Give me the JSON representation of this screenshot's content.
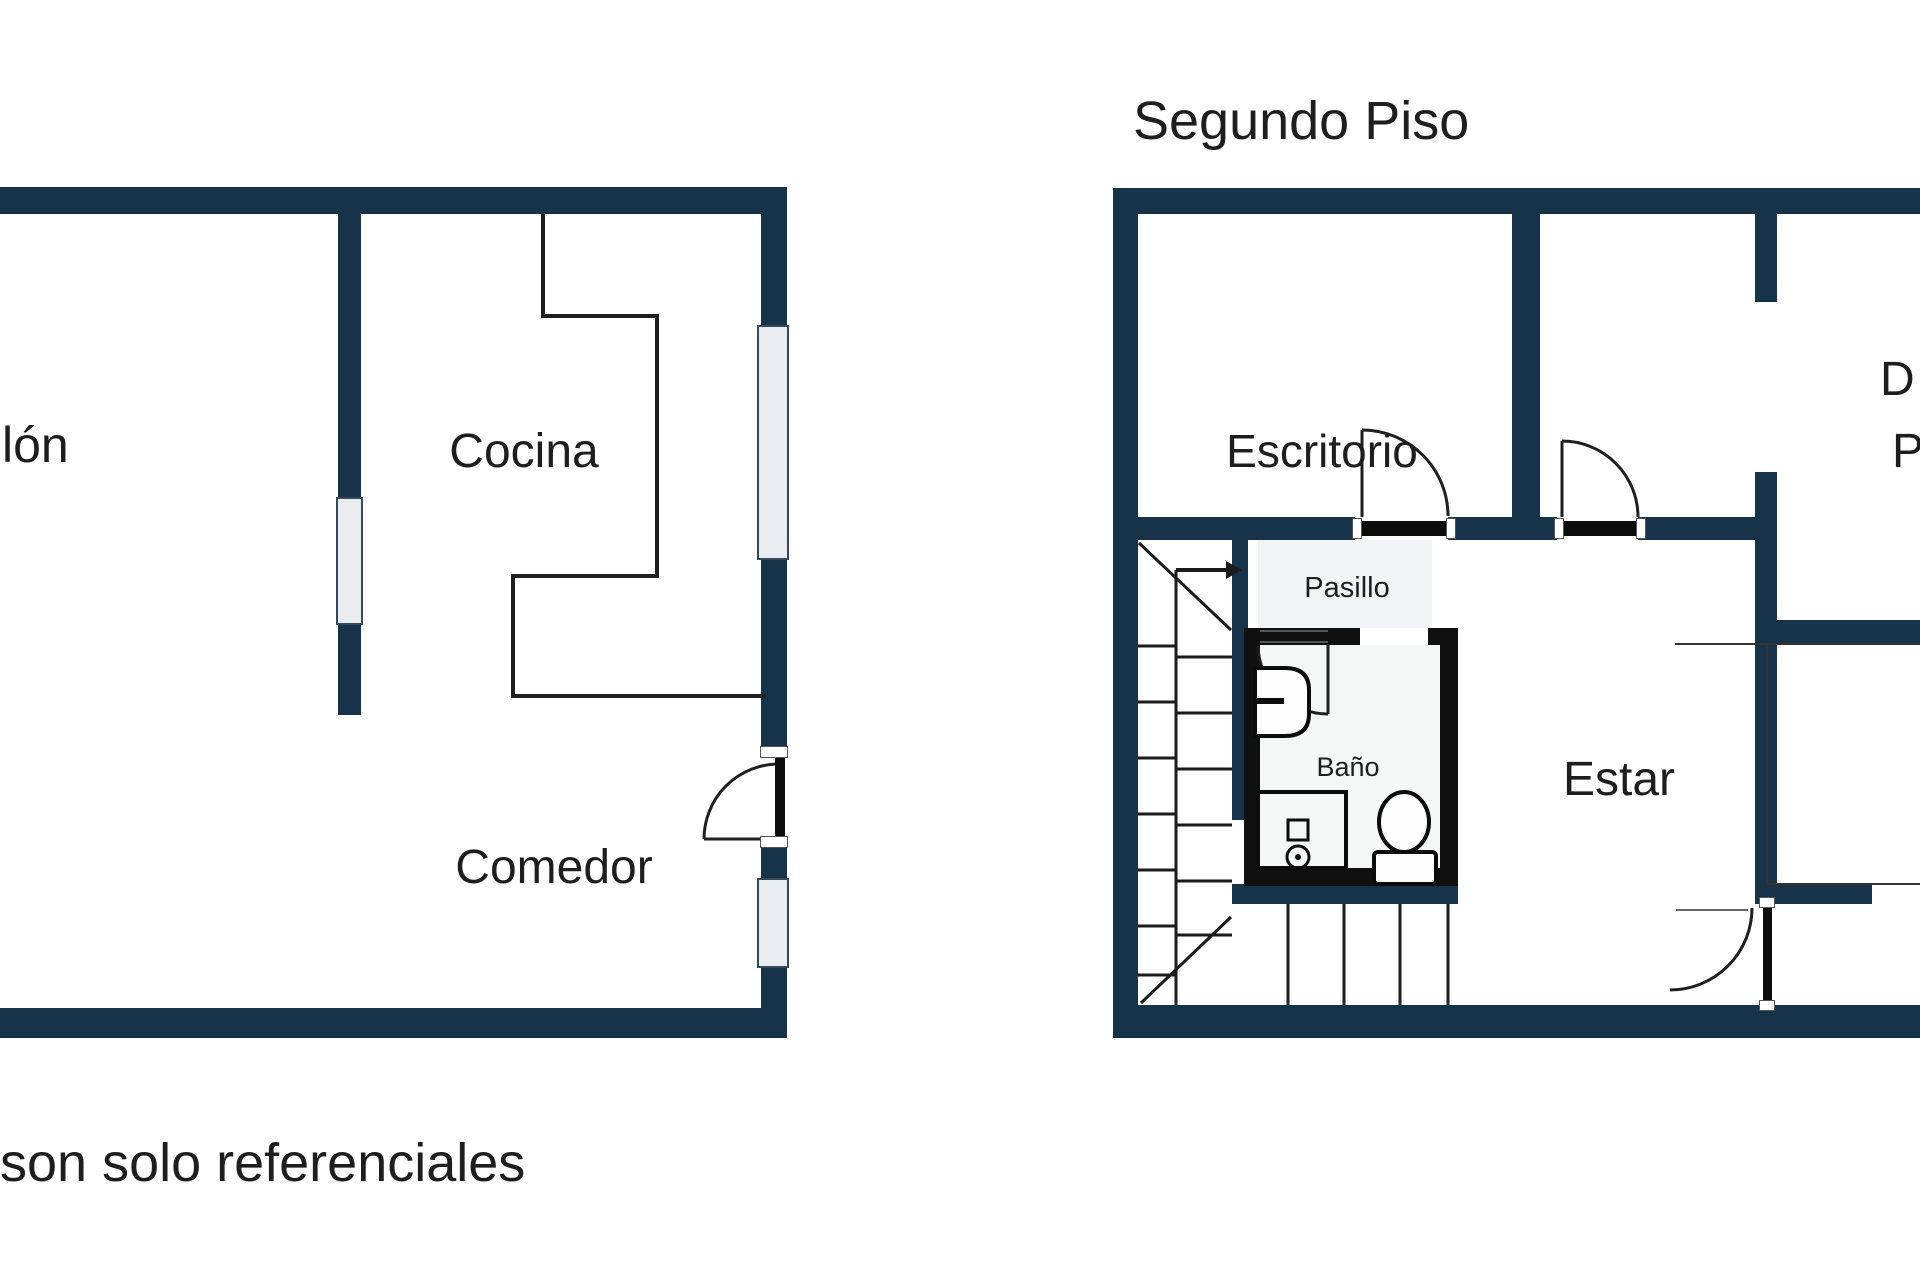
{
  "second_floor_title": "Segundo Piso",
  "footnote_fragment": "son solo referenciales",
  "floor1": {
    "salon_fragment": "lón",
    "cocina": "Cocina",
    "comedor": "Comedor"
  },
  "floor2": {
    "escritorio": "Escritorio",
    "dormitorio_fragment_line1": "D",
    "dormitorio_fragment_line2": "P",
    "pasillo": "Pasillo",
    "bano": "Baño",
    "estar": "Estar"
  },
  "colors": {
    "wall": "#16334a",
    "bathroom_wall": "#101010",
    "window_fill": "#e9edf0",
    "thin_line": "#1f1f1f",
    "text": "#1e1e1e",
    "background": "#ffffff"
  }
}
